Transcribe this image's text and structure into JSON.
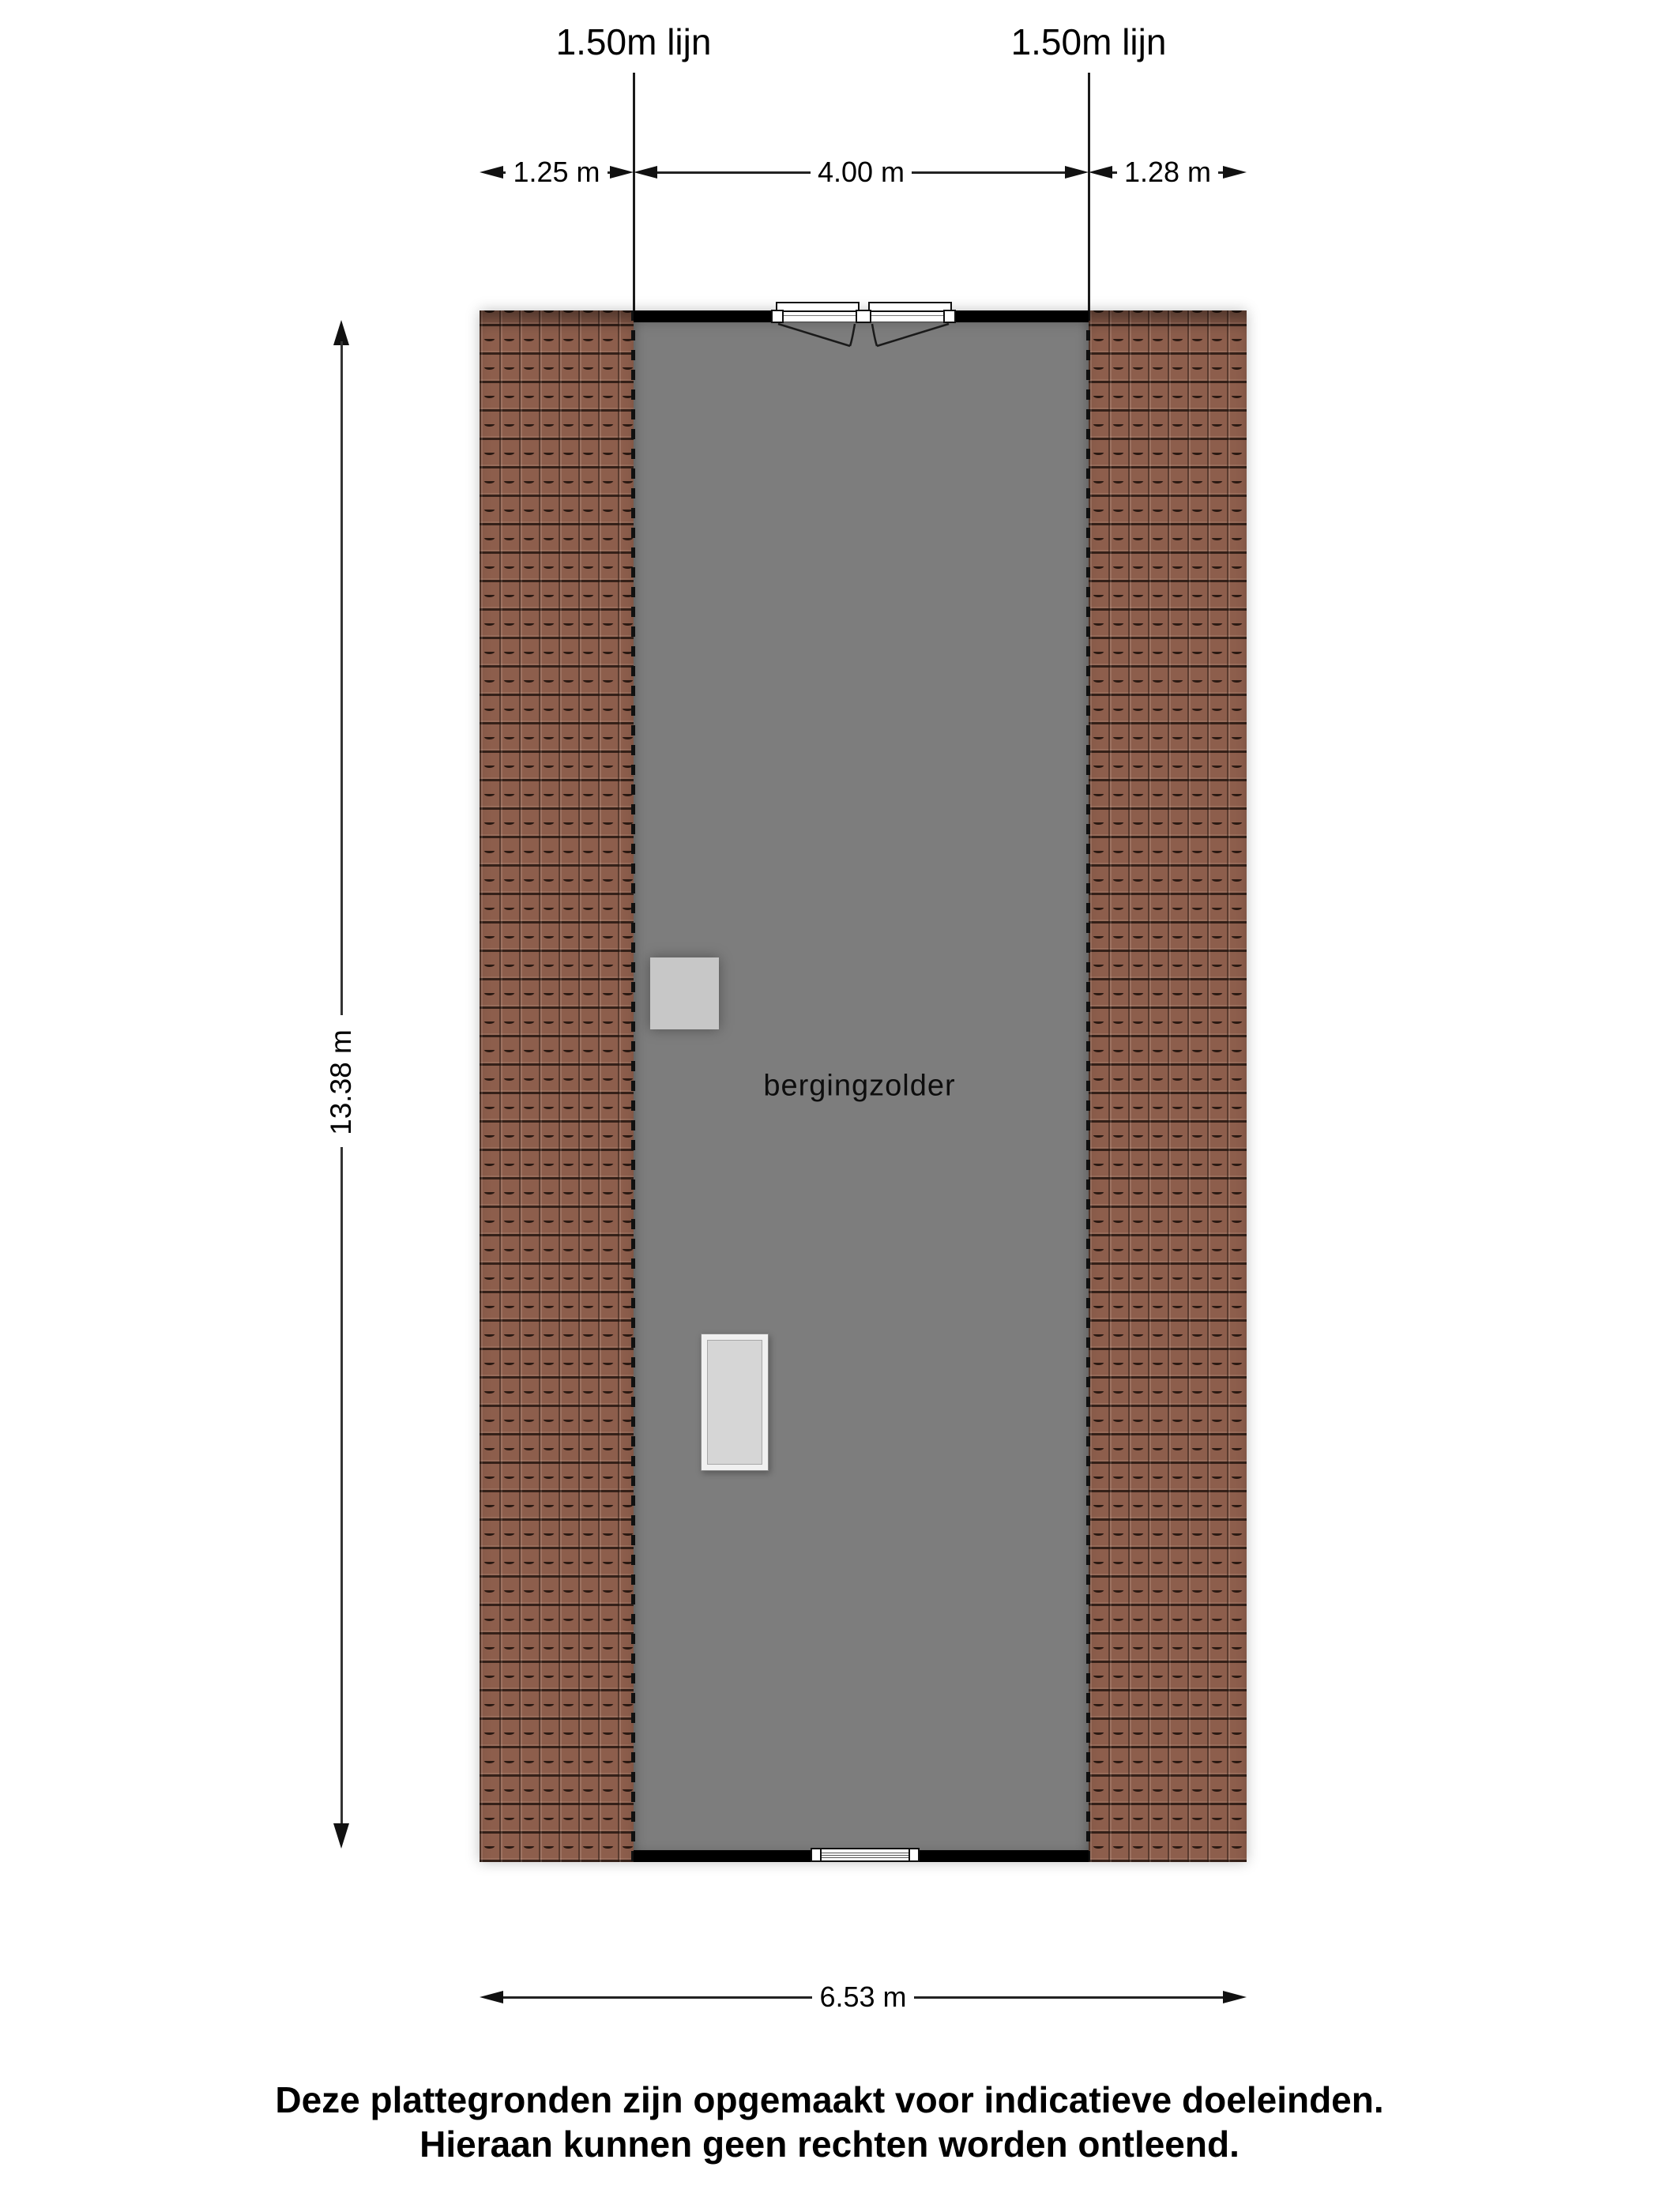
{
  "floorplan": {
    "room": {
      "label": "bergingzolder"
    },
    "height_lines": {
      "left": "1.50m lijn",
      "right": "1.50m lijn"
    },
    "dims": {
      "top_left": "1.25 m",
      "top_mid": "4.00 m",
      "top_right": "1.28 m",
      "side": "13.38 m",
      "bottom": "6.53 m"
    },
    "colors": {
      "roof_tile": "#8d5e4c",
      "roof_tile_line": "#26160f",
      "floor": "#7d7d7d",
      "wall": "#000000",
      "chimney": "#c7c7c7",
      "skylight_frame": "#f0f0f0",
      "skylight_fill": "#d6d6d6"
    }
  },
  "footer": {
    "line1": "Deze plattegronden zijn opgemaakt voor indicatieve doeleinden.",
    "line2": "Hieraan kunnen geen rechten worden ontleend."
  }
}
